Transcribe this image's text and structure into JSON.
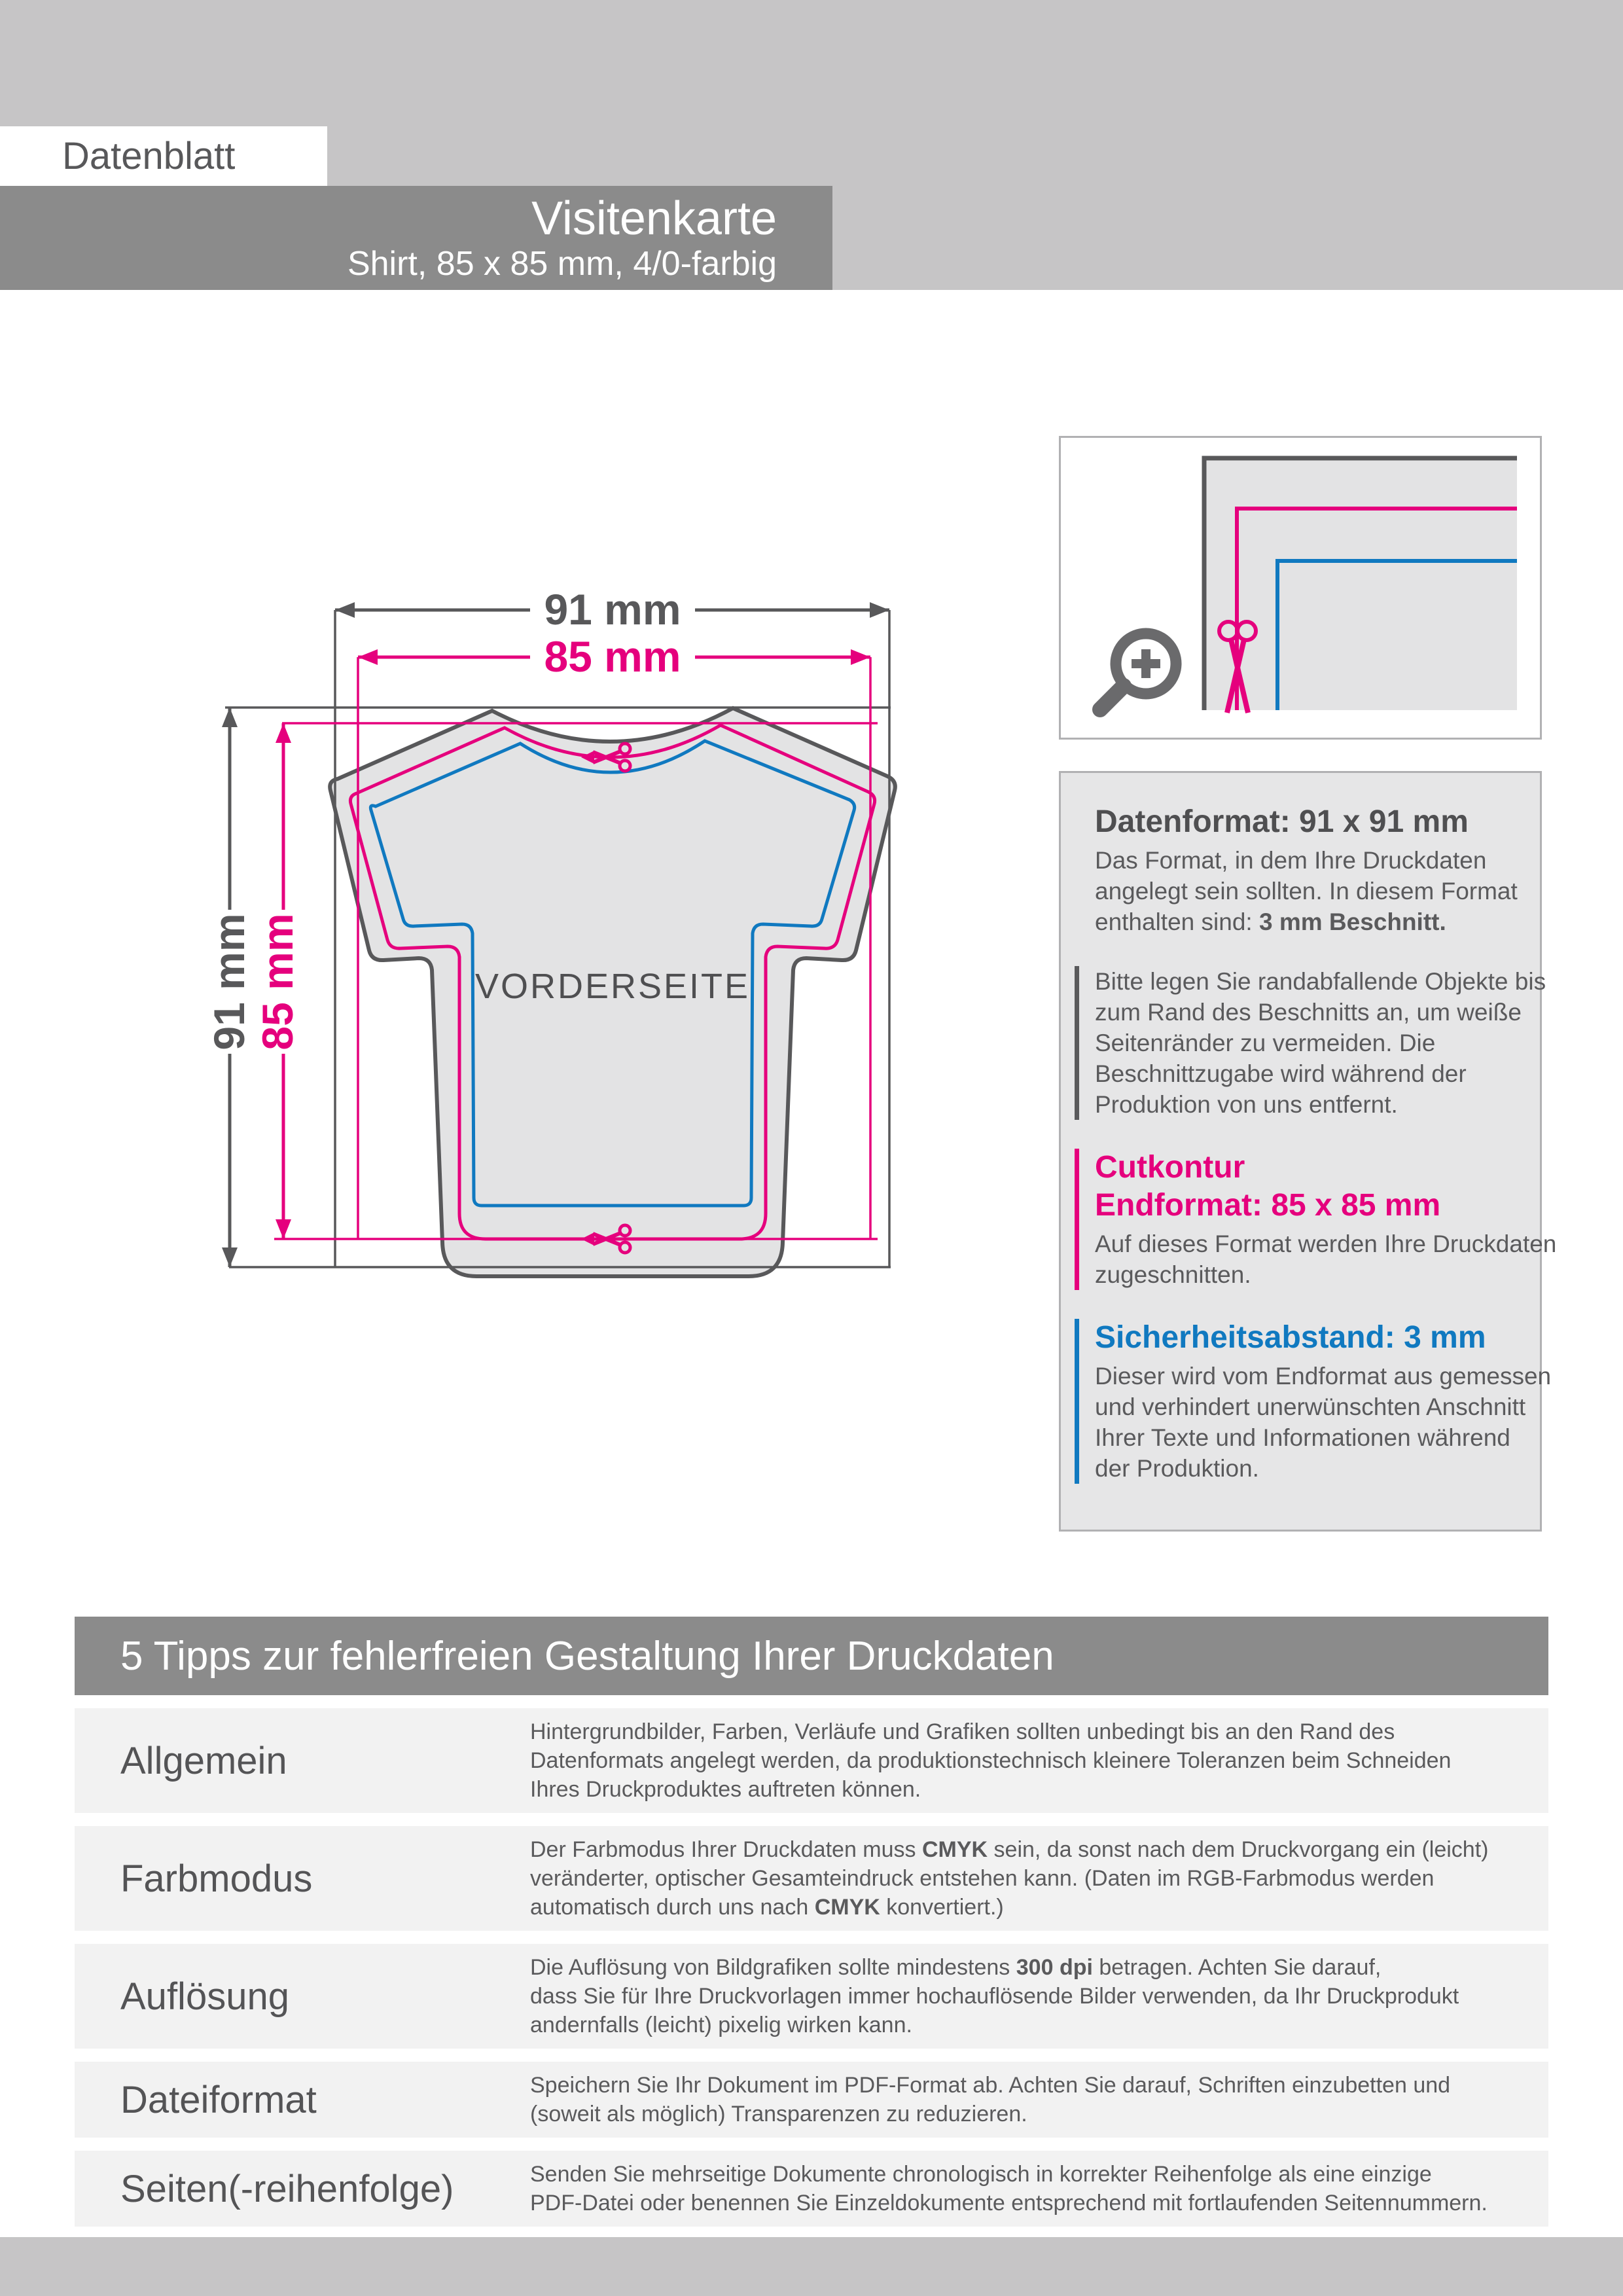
{
  "header": {
    "datenblatt_label": "Datenblatt",
    "title": "Visitenkarte",
    "subtitle": "Shirt, 85 x 85 mm, 4/0-farbig"
  },
  "colors": {
    "magenta": "#e5007d",
    "blue": "#1079c0",
    "gray_line": "#58585a",
    "band_gray": "#8b8b8b",
    "silver": "#c6c5c6",
    "paper_fill": "#e3e3e4"
  },
  "diagram": {
    "width_bleed_label": "91 mm",
    "width_cut_label": "85 mm",
    "height_bleed_label": "91 mm",
    "height_cut_label": "85 mm",
    "front_label": "VORDERSEITE",
    "icons": [
      "magnifier-plus-icon",
      "scissors-icon"
    ]
  },
  "info_panel": {
    "datenformat": {
      "heading": "Datenformat: 91 x 91 mm",
      "lines": [
        [
          {
            "t": "Das Format, in dem Ihre Druckdaten"
          }
        ],
        [
          {
            "t": "angelegt sein sollten. In diesem Format"
          }
        ],
        [
          {
            "t": "enthalten sind: "
          },
          {
            "t": "3 mm Beschnitt.",
            "b": true
          }
        ]
      ]
    },
    "beschnitt_note": {
      "lines": [
        [
          {
            "t": "Bitte legen Sie randabfallende Objekte bis"
          }
        ],
        [
          {
            "t": "zum Rand des Beschnitts an, um weiße"
          }
        ],
        [
          {
            "t": "Seitenränder zu vermeiden. Die"
          }
        ],
        [
          {
            "t": "Beschnittzugabe wird während der"
          }
        ],
        [
          {
            "t": "Produktion von uns entfernt."
          }
        ]
      ]
    },
    "cutkontur": {
      "heading_line1": "Cutkontur",
      "heading_line2": "Endformat: 85 x 85 mm",
      "lines": [
        [
          {
            "t": "Auf dieses Format werden Ihre Druckdaten"
          }
        ],
        [
          {
            "t": "zugeschnitten."
          }
        ]
      ]
    },
    "sicherheitsabstand": {
      "heading": "Sicherheitsabstand: 3 mm",
      "lines": [
        [
          {
            "t": "Dieser wird vom Endformat aus gemessen"
          }
        ],
        [
          {
            "t": "und verhindert unerwünschten Anschnitt"
          }
        ],
        [
          {
            "t": "Ihrer Texte und Informationen während"
          }
        ],
        [
          {
            "t": "der Produktion."
          }
        ]
      ]
    }
  },
  "tips": {
    "heading": "5 Tipps zur fehlerfreien Gestaltung Ihrer Druckdaten",
    "rows": [
      {
        "label": "Allgemein",
        "lines": [
          [
            {
              "t": "Hintergrundbilder, Farben, Verläufe und Grafiken sollten unbedingt bis an den Rand des"
            }
          ],
          [
            {
              "t": "Datenformats angelegt werden, da produktionstechnisch kleinere Toleranzen beim Schneiden"
            }
          ],
          [
            {
              "t": "Ihres Druckproduktes auftreten können."
            }
          ]
        ]
      },
      {
        "label": "Farbmodus",
        "lines": [
          [
            {
              "t": "Der Farbmodus Ihrer Druckdaten muss "
            },
            {
              "t": "CMYK",
              "b": true
            },
            {
              "t": " sein, da sonst nach dem Druckvorgang ein (leicht)"
            }
          ],
          [
            {
              "t": "veränderter, optischer Gesamteindruck entstehen kann. (Daten im RGB-Farbmodus werden"
            }
          ],
          [
            {
              "t": "automatisch durch uns nach "
            },
            {
              "t": "CMYK",
              "b": true
            },
            {
              "t": " konvertiert.)"
            }
          ]
        ]
      },
      {
        "label": "Auflösung",
        "lines": [
          [
            {
              "t": "Die Auflösung von Bildgrafiken sollte mindestens "
            },
            {
              "t": "300 dpi",
              "b": true
            },
            {
              "t": " betragen. Achten Sie darauf,"
            }
          ],
          [
            {
              "t": "dass Sie für Ihre Druckvorlagen immer hochauflösende Bilder verwenden, da Ihr Druckprodukt"
            }
          ],
          [
            {
              "t": "andernfalls (leicht) pixelig wirken kann."
            }
          ]
        ]
      },
      {
        "label": "Dateiformat",
        "lines": [
          [
            {
              "t": "Speichern Sie Ihr Dokument im PDF-Format ab. Achten Sie darauf, Schriften einzubetten und"
            }
          ],
          [
            {
              "t": "(soweit als möglich) Transparenzen zu reduzieren."
            }
          ]
        ]
      },
      {
        "label": "Seiten(-reihenfolge)",
        "lines": [
          [
            {
              "t": "Senden Sie mehrseitige Dokumente chronologisch in korrekter Reihenfolge als eine einzige"
            }
          ],
          [
            {
              "t": "PDF-Datei oder benennen Sie Einzeldokumente entsprechend mit fortlaufenden Seitennummern."
            }
          ]
        ]
      }
    ]
  }
}
